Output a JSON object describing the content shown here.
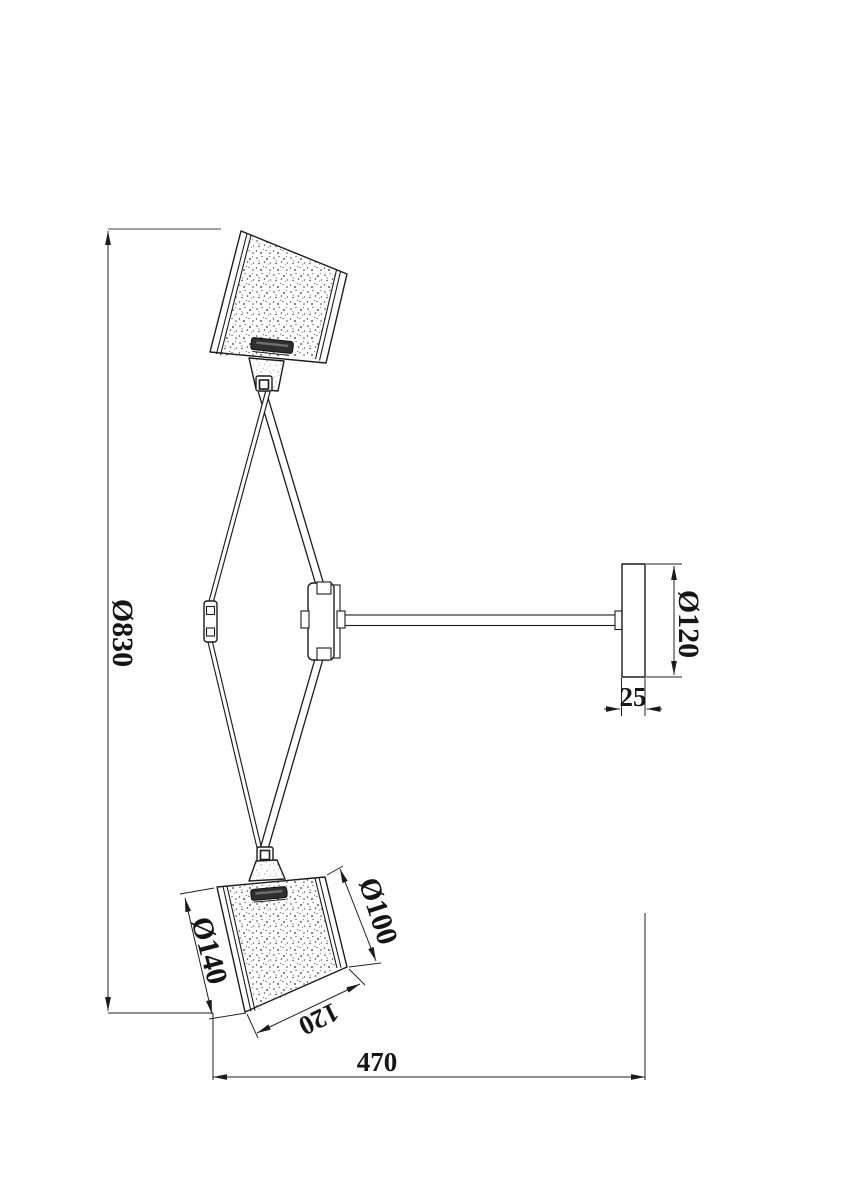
{
  "drawing": {
    "background": "#ffffff",
    "line_color": "#1c1c1c",
    "dimensions": {
      "overall_height": "Ø830",
      "canopy_diameter": "Ø120",
      "canopy_depth": "25",
      "shade_bottom_diameter": "Ø140",
      "shade_top_diameter": "Ø100",
      "shade_height": "120",
      "wall_projection": "470"
    }
  }
}
